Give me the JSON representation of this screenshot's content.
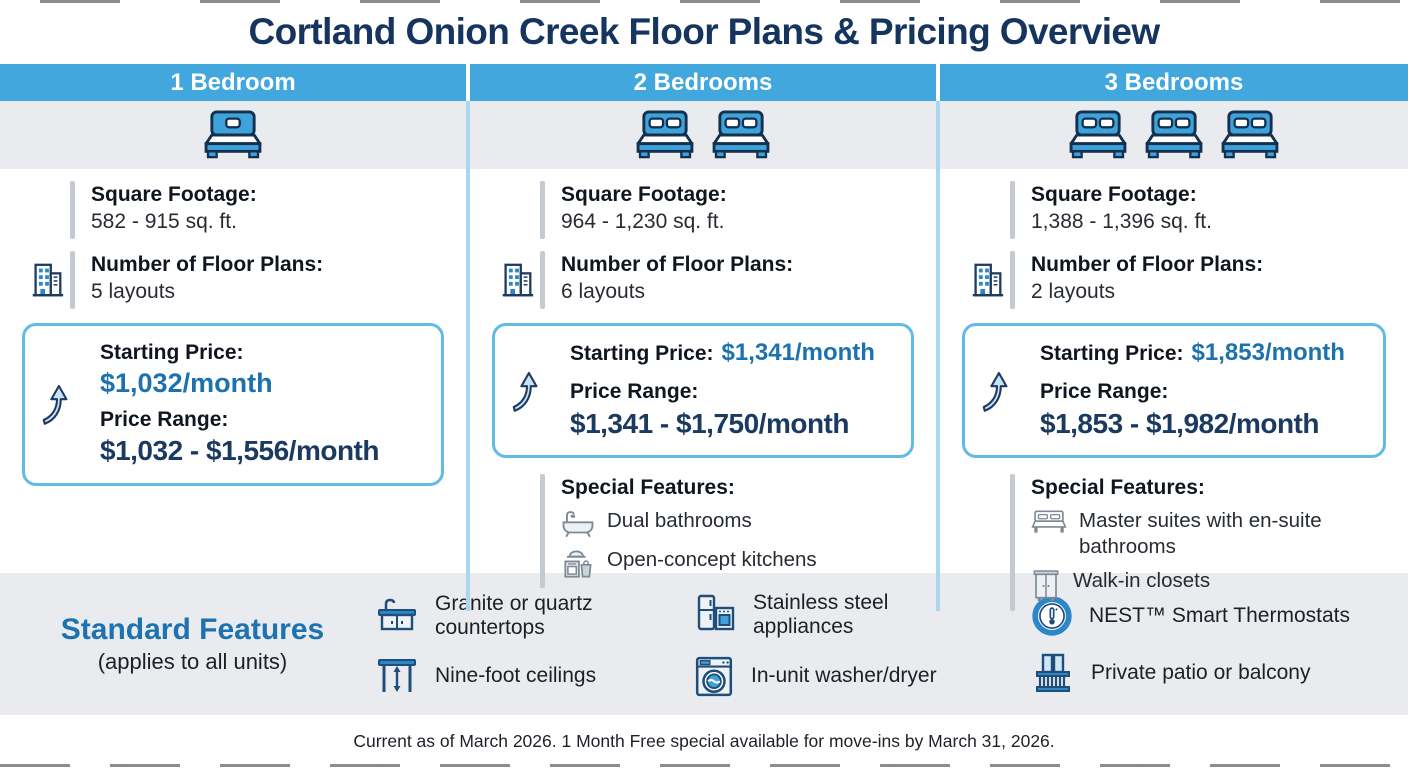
{
  "title": "Cortland Onion Creek Floor Plans & Pricing Overview",
  "columns": [
    {
      "header": "1 Bedroom",
      "square_footage_label": "Square Footage:",
      "square_footage": "582 - 915 sq. ft.",
      "floor_plans_label": "Number of Floor Plans:",
      "floor_plans": "5 layouts",
      "starting_price_label": "Starting Price:",
      "starting_price": "$1,032/month",
      "price_range_label": "Price Range:",
      "price_range": "$1,032 - $1,556/month"
    },
    {
      "header": "2 Bedrooms",
      "square_footage_label": "Square Footage:",
      "square_footage": "964 - 1,230 sq. ft.",
      "floor_plans_label": "Number of Floor Plans:",
      "floor_plans": "6 layouts",
      "starting_price_label": "Starting Price:",
      "starting_price": "$1,341/month",
      "price_range_label": "Price Range:",
      "price_range": "$1,341 - $1,750/month",
      "special_features_label": "Special Features:",
      "special_features": [
        {
          "icon": "bathtub-icon",
          "label": "Dual bathrooms"
        },
        {
          "icon": "kitchen-icon",
          "label": "Open-concept kitchens"
        }
      ]
    },
    {
      "header": "3 Bedrooms",
      "square_footage_label": "Square Footage:",
      "square_footage": "1,388 - 1,396 sq. ft.",
      "floor_plans_label": "Number of Floor Plans:",
      "floor_plans": "2 layouts",
      "starting_price_label": "Starting Price:",
      "starting_price": "$1,853/month",
      "price_range_label": "Price Range:",
      "price_range": "$1,853 - $1,982/month",
      "special_features_label": "Special Features:",
      "special_features": [
        {
          "icon": "master-bed-icon",
          "label": "Master suites with en-suite bathrooms"
        },
        {
          "icon": "wardrobe-icon",
          "label": "Walk-in closets"
        }
      ]
    }
  ],
  "standard_features": {
    "heading": "Standard Features",
    "subheading": "(applies to all units)",
    "items": [
      {
        "icon": "countertop-icon",
        "label": "Granite or quartz countertops"
      },
      {
        "icon": "ceiling-height-icon",
        "label": "Nine-foot ceilings"
      },
      {
        "icon": "appliances-icon",
        "label": "Stainless steel appliances"
      },
      {
        "icon": "washer-icon",
        "label": "In-unit washer/dryer"
      },
      {
        "icon": "thermostat-icon",
        "label": "NEST™ Smart Thermostats"
      },
      {
        "icon": "balcony-icon",
        "label": "Private patio or balcony"
      }
    ]
  },
  "footer": {
    "note": "Current as of March 2026. 1 Month Free special available for move-ins by March 31, 2026."
  },
  "colors": {
    "header_band": "#41A7DC",
    "title_navy": "#16355E",
    "price_blue": "#1C72AE",
    "price_navy": "#1B3A60",
    "box_border": "#62BAE6",
    "divider_blue": "#A9D7EF",
    "band_gray": "#E9EBEE",
    "standard_heading_blue": "#1D72B0"
  }
}
